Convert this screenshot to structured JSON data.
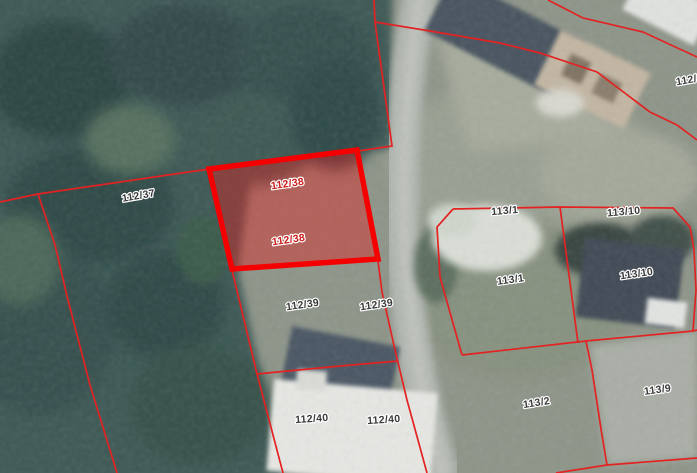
{
  "map": {
    "type": "cadastral-parcel-map",
    "colors": {
      "boundary": "#e32222",
      "highlight_stroke": "#f40000",
      "highlight_fill": "rgba(228,30,30,0.42)",
      "label": "#3a3a3a",
      "label_highlight": "#cc1d1d",
      "label_halo": "#ffffff"
    },
    "selected_parcel": {
      "id": "112/38",
      "points": "209,169 357,150 378,259 232,269",
      "labels": [
        {
          "text": "112/38",
          "x": 288,
          "y": 187,
          "rot": -8
        },
        {
          "text": "112/38",
          "x": 289,
          "y": 243,
          "rot": -8
        }
      ]
    },
    "boundaries": [
      {
        "points": "0,202 38,194 209,169"
      },
      {
        "points": "38,194 55,245 68,300 90,385 117,473"
      },
      {
        "points": "374,0 375,22 392,146 358,151"
      },
      {
        "points": "375,22 430,31 500,43 540,53 597,72 630,97 650,112 677,125 697,140"
      },
      {
        "points": "548,0 583,18 643,32 697,57"
      },
      {
        "points": "453,209 560,207 673,208 690,227 694,250 696,290 693,331"
      },
      {
        "points": "453,209 437,227 440,277 462,355"
      },
      {
        "points": "462,355 586,341 693,331 697,330"
      },
      {
        "points": "560,207 578,343"
      },
      {
        "points": "586,341 592,370 601,429 607,465"
      },
      {
        "points": "556,473 607,465 697,458"
      },
      {
        "points": "378,261 382,292 395,350 407,400 427,473"
      },
      {
        "points": "232,270 257,374 283,473"
      },
      {
        "points": "257,374 340,366 398,361"
      }
    ],
    "labels": [
      {
        "text": "112/37",
        "x": 139,
        "y": 199,
        "rot": -10
      },
      {
        "text": "112/39",
        "x": 303,
        "y": 308,
        "rot": -8
      },
      {
        "text": "112/39",
        "x": 377,
        "y": 308,
        "rot": -8
      },
      {
        "text": "112/40",
        "x": 312,
        "y": 422,
        "rot": -4
      },
      {
        "text": "112/40",
        "x": 384,
        "y": 423,
        "rot": -4
      },
      {
        "text": "113/1",
        "x": 505,
        "y": 214,
        "rot": -5
      },
      {
        "text": "113/1",
        "x": 511,
        "y": 283,
        "rot": -8
      },
      {
        "text": "113/10",
        "x": 624,
        "y": 215,
        "rot": -5
      },
      {
        "text": "113/10",
        "x": 637,
        "y": 277,
        "rot": -8
      },
      {
        "text": "113/2",
        "x": 537,
        "y": 406,
        "rot": -9
      },
      {
        "text": "113/9",
        "x": 658,
        "y": 393,
        "rot": -8
      },
      {
        "text": "112/3",
        "x": 690,
        "y": 83,
        "rot": -10
      }
    ]
  }
}
